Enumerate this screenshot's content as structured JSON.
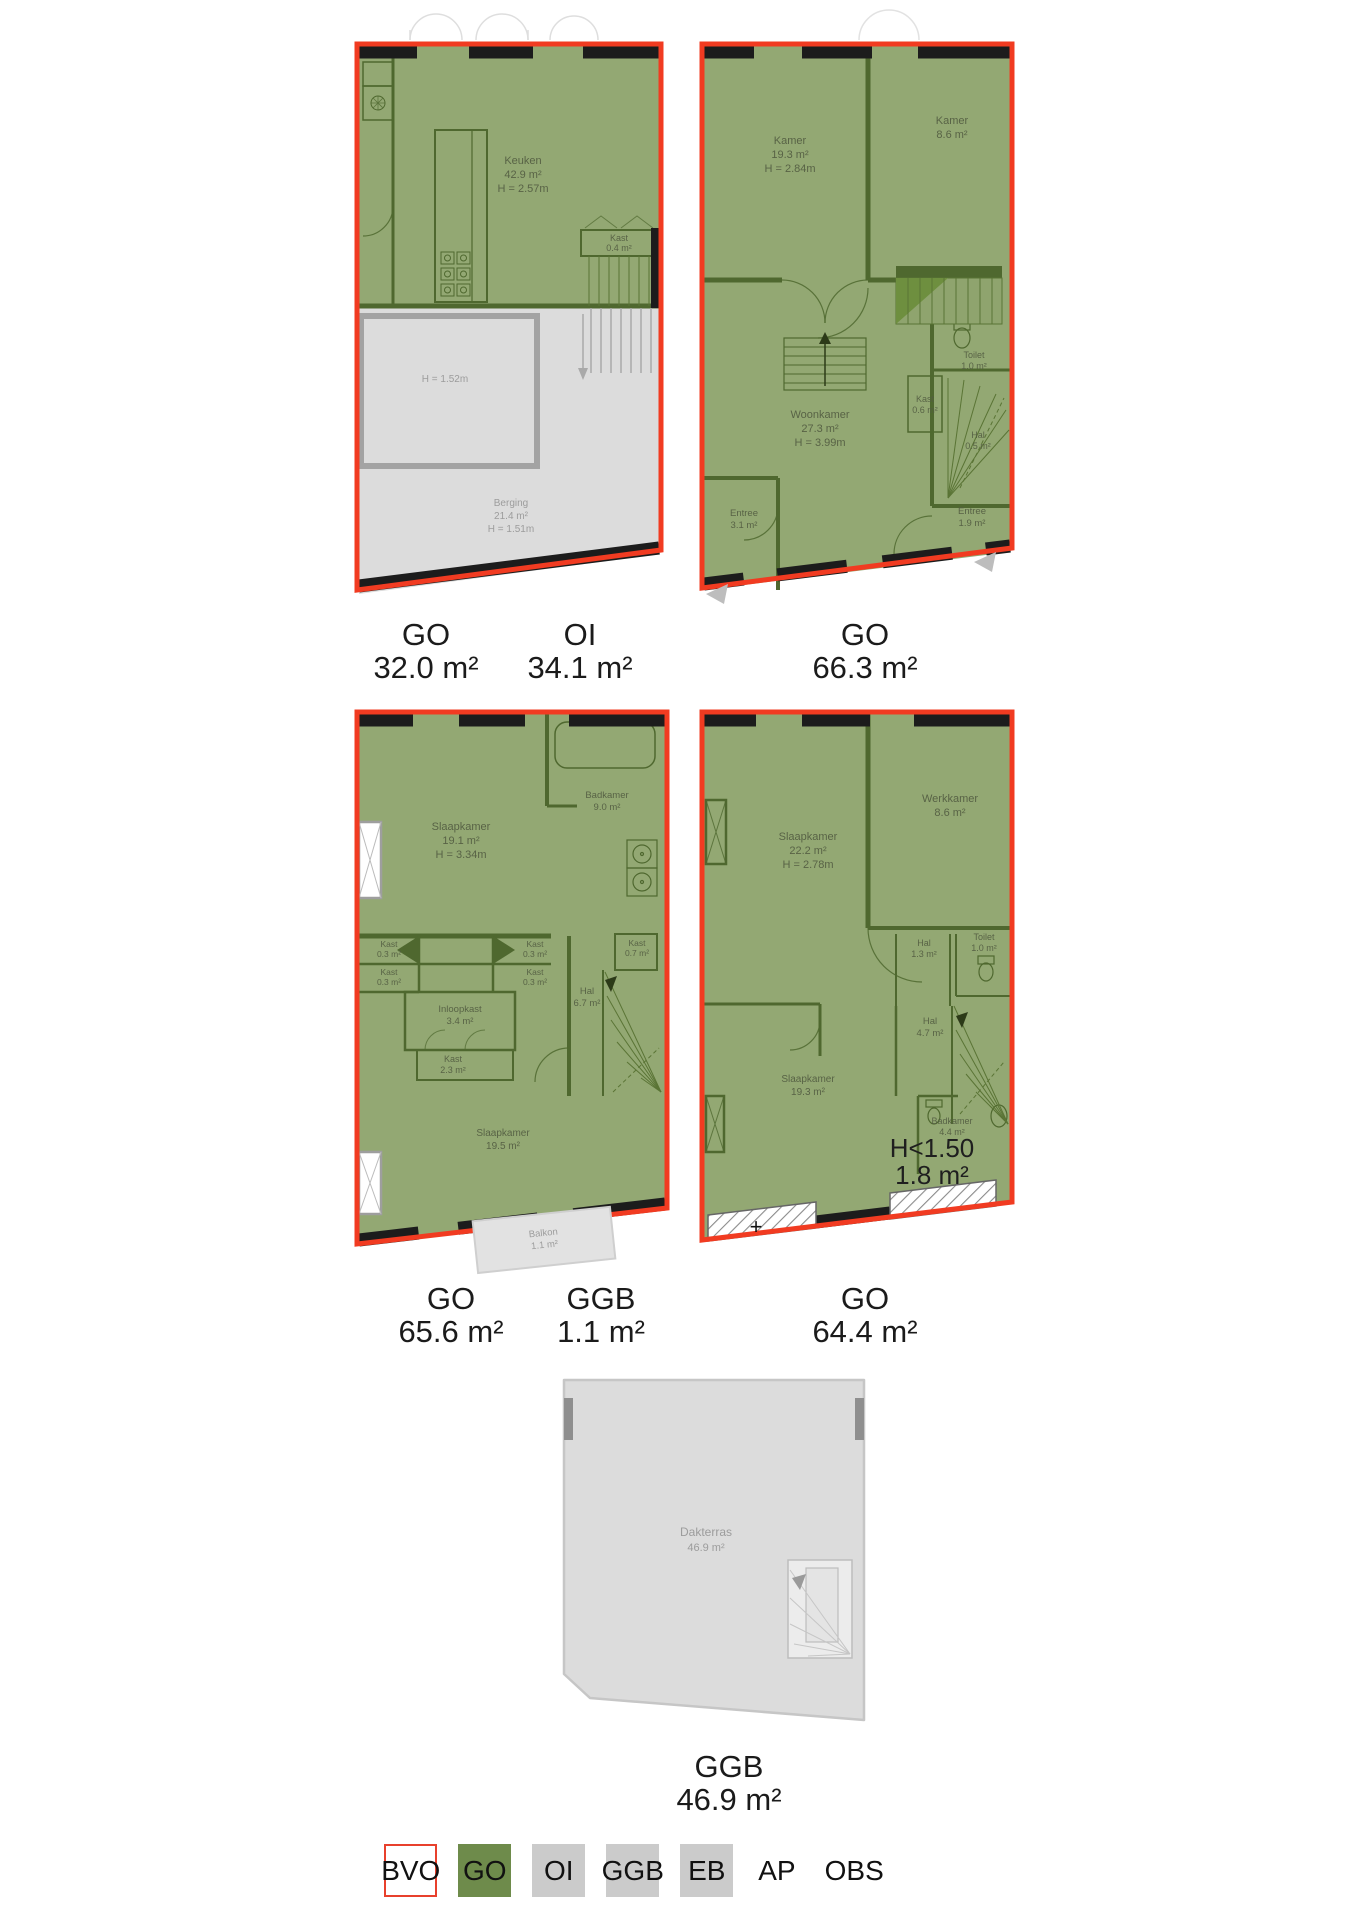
{
  "colors": {
    "plan_green": "#93A873",
    "wall_green": "#4F682F",
    "stair_green": "#6E8F3F",
    "plan_grey": "#DCDCDC",
    "outline_red": "#F13B21",
    "band_black": "#1C1C1C",
    "legend_green": "#6E8B4B",
    "legend_grey": "#CBCBCB"
  },
  "plans": {
    "p1": {
      "rooms": {
        "keuken": {
          "name": "Keuken",
          "area": "42.9 m²",
          "h": "H = 2.57m"
        },
        "kast": {
          "name": "Kast",
          "area": "0.4 m²"
        },
        "inner_h": "H = 1.52m",
        "berging": {
          "name": "Berging",
          "area": "21.4 m²",
          "h": "H = 1.51m"
        }
      }
    },
    "p2": {
      "rooms": {
        "kamer1": {
          "name": "Kamer",
          "area": "19.3 m²",
          "h": "H = 2.84m"
        },
        "kamer2": {
          "name": "Kamer",
          "area": "8.6 m²"
        },
        "woonkamer": {
          "name": "Woonkamer",
          "area": "27.3 m²",
          "h": "H = 3.99m"
        },
        "toilet": {
          "name": "Toilet",
          "area": "1.0 m²"
        },
        "kast": {
          "name": "Kast",
          "area": "0.6 m²"
        },
        "hal": {
          "name": "Hal",
          "area": "0.5 m²"
        },
        "entree1": {
          "name": "Entree",
          "area": "3.1 m²"
        },
        "entree2": {
          "name": "Entree",
          "area": "1.9 m²"
        }
      }
    },
    "p3": {
      "rooms": {
        "slaapkamer1": {
          "name": "Slaapkamer",
          "area": "19.1 m²",
          "h": "H = 3.34m"
        },
        "badkamer": {
          "name": "Badkamer",
          "area": "9.0 m²"
        },
        "kast_a": {
          "name": "Kast",
          "area": "0.3 m²"
        },
        "kast_b": {
          "name": "Kast",
          "area": "0.3 m²"
        },
        "kast_c": {
          "name": "Kast",
          "area": "0.3 m²"
        },
        "kast_d": {
          "name": "Kast",
          "area": "0.3 m²"
        },
        "kast_e": {
          "name": "Kast",
          "area": "0.7 m²"
        },
        "inloopkast": {
          "name": "Inloopkast",
          "area": "3.4 m²"
        },
        "hal": {
          "name": "Hal",
          "area": "6.7 m²"
        },
        "kast_f": {
          "name": "Kast",
          "area": "2.3 m²"
        },
        "slaapkamer2": {
          "name": "Slaapkamer",
          "area": "19.5 m²"
        },
        "balkon": {
          "name": "Balkon",
          "area": "1.1 m²"
        }
      }
    },
    "p4": {
      "rooms": {
        "slaapkamer1": {
          "name": "Slaapkamer",
          "area": "22.2 m²",
          "h": "H = 2.78m"
        },
        "werkkamer": {
          "name": "Werkkamer",
          "area": "8.6 m²"
        },
        "hal1": {
          "name": "Hal",
          "area": "1.3 m²"
        },
        "toilet": {
          "name": "Toilet",
          "area": "1.0 m²"
        },
        "hal2": {
          "name": "Hal",
          "area": "4.7 m²"
        },
        "slaapkamer2": {
          "name": "Slaapkamer",
          "area": "19.3 m²"
        },
        "badkamer": {
          "name": "Badkamer",
          "area": "4.4 m²"
        },
        "low_height": {
          "line1": "H<1.50",
          "line2": "1.8 m²"
        },
        "plus": "+"
      }
    },
    "p5": {
      "rooms": {
        "dakterras": {
          "name": "Dakterras",
          "area": "46.9 m²"
        }
      }
    }
  },
  "captions": {
    "row1": [
      {
        "code": "GO",
        "area": "32.0 m²"
      },
      {
        "code": "OI",
        "area": "34.1 m²"
      },
      {
        "code": "GO",
        "area": "66.3 m²"
      }
    ],
    "row2": [
      {
        "code": "GO",
        "area": "65.6 m²"
      },
      {
        "code": "GGB",
        "area": "1.1 m²"
      },
      {
        "code": "GO",
        "area": "64.4 m²"
      }
    ],
    "row3": [
      {
        "code": "GGB",
        "area": "46.9 m²"
      }
    ]
  },
  "legend": {
    "items": [
      {
        "label": "BVO",
        "box": "bvo"
      },
      {
        "label": "GO",
        "box": "go"
      },
      {
        "label": "OI",
        "box": "grey"
      },
      {
        "label": "GGB",
        "box": "grey"
      },
      {
        "label": "EB",
        "box": "grey"
      },
      {
        "label": "AP",
        "box": "none"
      },
      {
        "label": "OBS",
        "box": "none"
      }
    ]
  }
}
